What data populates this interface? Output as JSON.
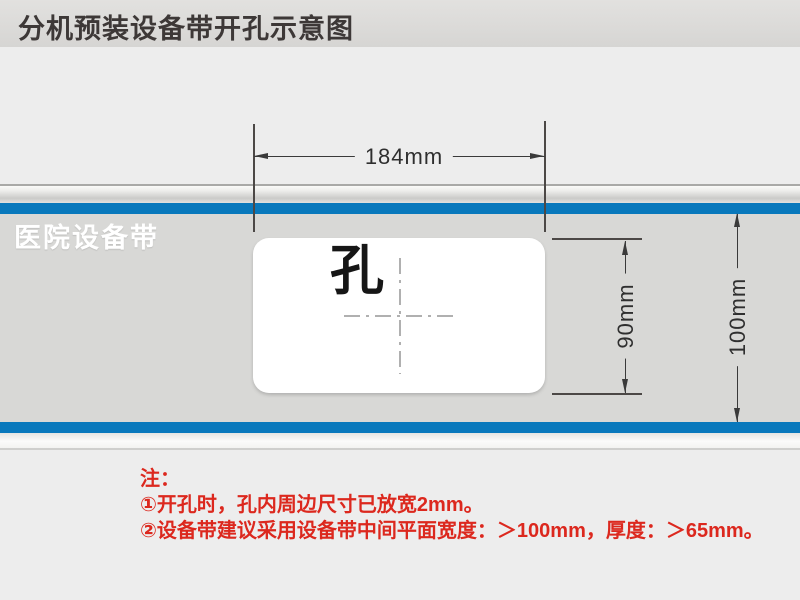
{
  "title": "分机预装设备带开孔示意图",
  "band": {
    "label": "医院设备带",
    "stripe_color": "#0878bc",
    "face_color": "#d8d8d6"
  },
  "hole": {
    "label": "孔"
  },
  "dims": {
    "width_label": "184mm",
    "hole_height_label": "90mm",
    "band_height_label": "100mm"
  },
  "notes": {
    "heading": "注：",
    "items": [
      "①开孔时，孔内周边尺寸已放宽2mm。",
      "②设备带建议采用设备带中间平面宽度：＞100mm，厚度：＞65mm。"
    ],
    "text_color": "#dc281e"
  }
}
